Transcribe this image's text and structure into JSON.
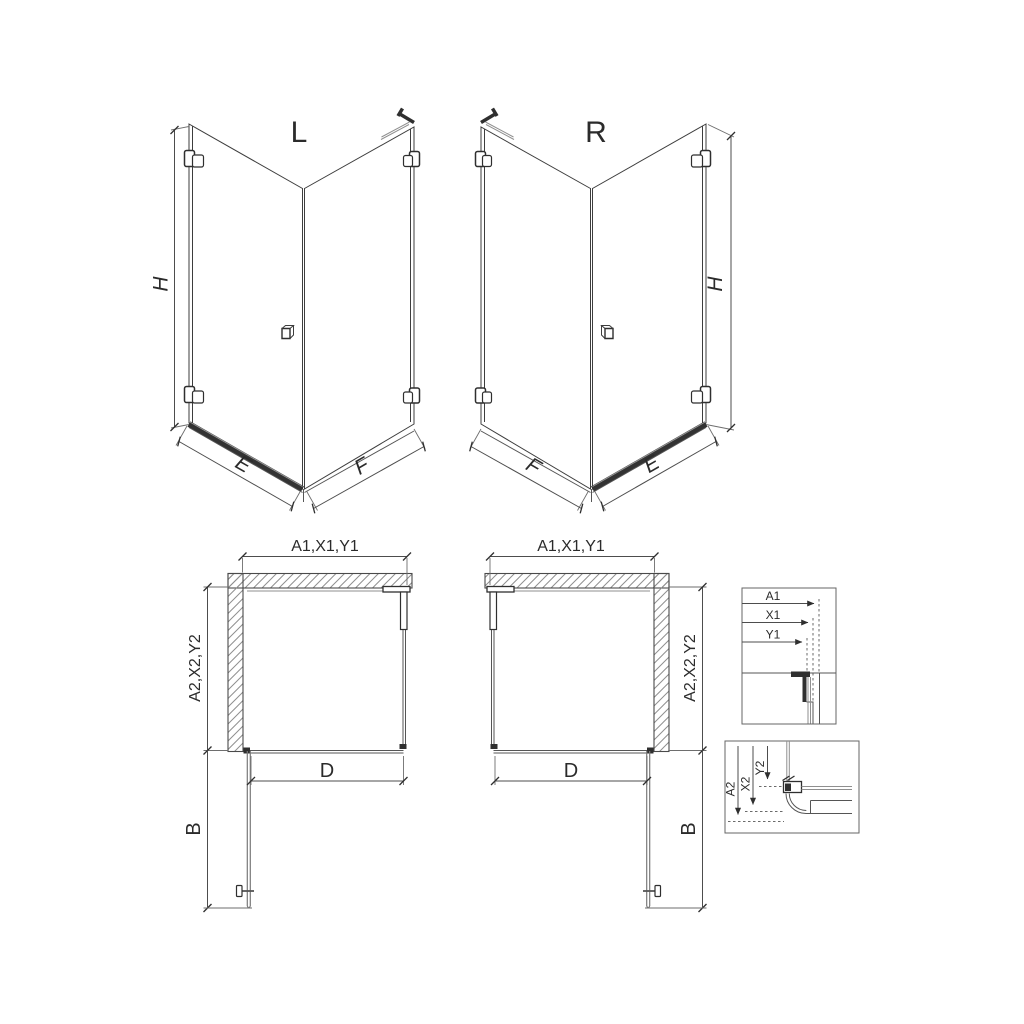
{
  "colors": {
    "background": "#ffffff",
    "line_dark": "#2f2f2f",
    "line_medium": "#555555",
    "glass_edge": "#8f8f8f",
    "dimension_line": "#4d4d4d",
    "text": "#2b2b2b"
  },
  "views": {
    "perspective_left": {
      "title": "L",
      "dim_height": "H",
      "dim_door_width": "E",
      "dim_side_width": "F"
    },
    "perspective_right": {
      "title": "R",
      "dim_height": "H",
      "dim_door_width": "E",
      "dim_side_width": "F"
    },
    "plan_left": {
      "dim_width": "A1,X1,Y1",
      "dim_depth": "A2,X2,Y2",
      "dim_door_opening": "D",
      "dim_door_projection": "B"
    },
    "plan_right": {
      "dim_width": "A1,X1,Y1",
      "dim_depth": "A2,X2,Y2",
      "dim_door_opening": "D",
      "dim_door_projection": "B"
    },
    "detail_wall_profile": {
      "dims": [
        "A1",
        "X1",
        "Y1"
      ]
    },
    "detail_floor_profile": {
      "dims": [
        "A2",
        "X2",
        "Y2"
      ]
    }
  }
}
